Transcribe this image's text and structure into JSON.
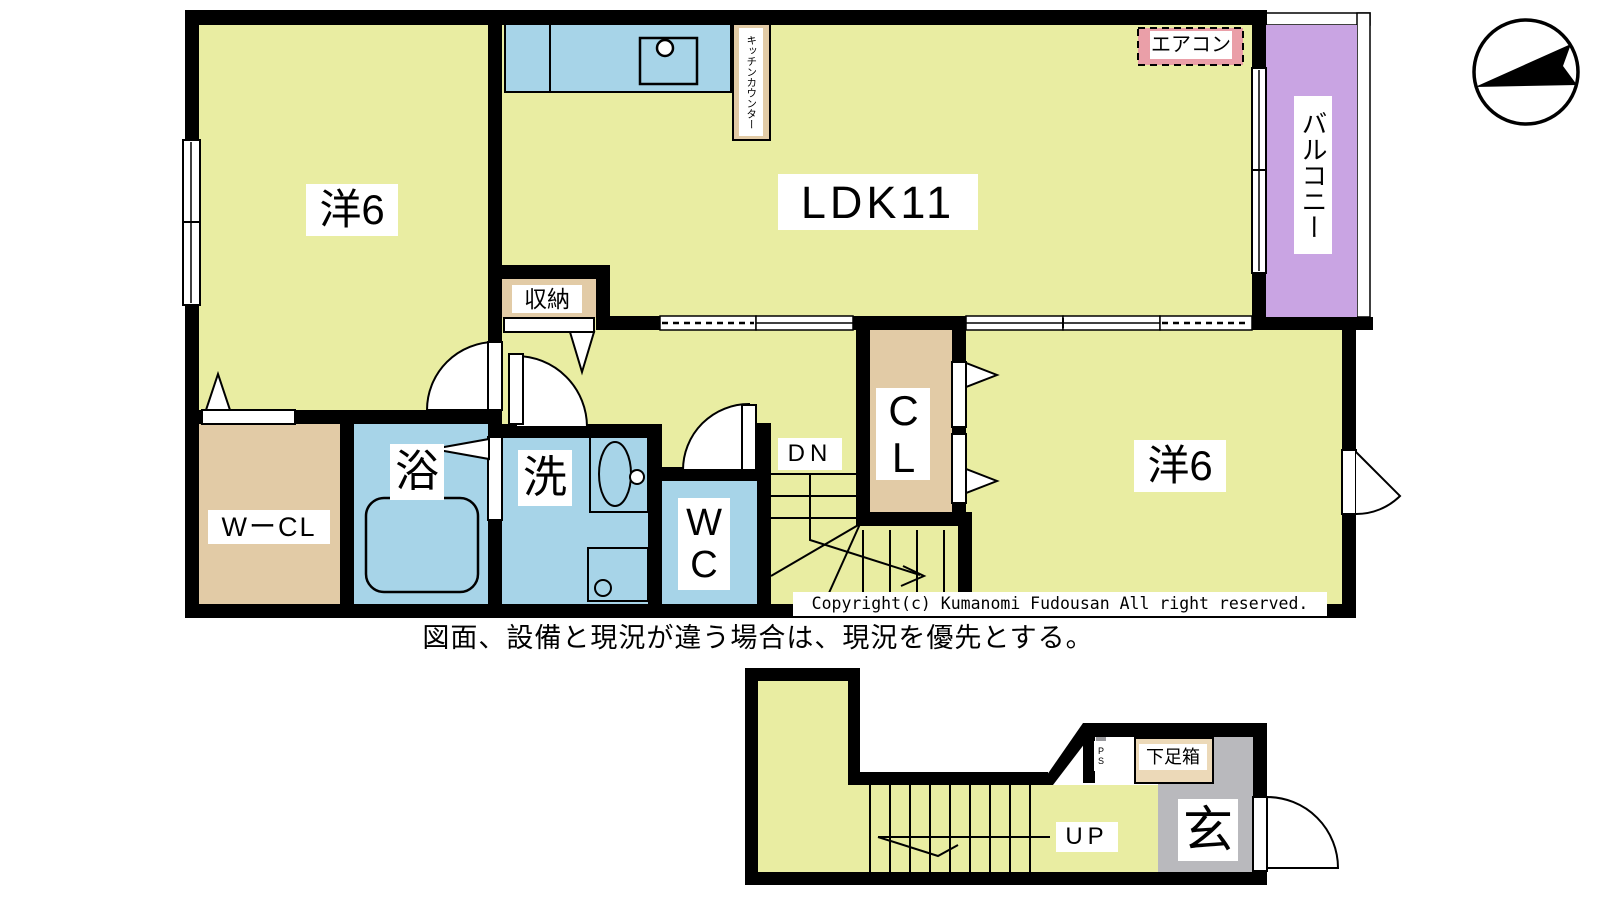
{
  "colors": {
    "floor_yellow": "#e9eda2",
    "water_blue": "#a7d4e8",
    "closet_tan": "#e2cba6",
    "shoebox_tan": "#ecd9b8",
    "balcony_purple": "#c9a4e3",
    "aircon_pink": "#ea9fa8",
    "entry_gray": "#b9b9bd",
    "ps_gray": "#9a9a9e",
    "wall_black": "#000000"
  },
  "floor2": {
    "rooms": {
      "western_left": "洋6",
      "ldk": "LDK11",
      "western_right": "洋6",
      "storage": "収納",
      "bath": "浴",
      "wash": "洗",
      "wc": "WC",
      "closet": "CL",
      "walkin_closet": "WーCL",
      "balcony": "バルコニー",
      "kitchen_counter": "キッチンカウンター",
      "aircon": "エアコン",
      "stairs_down": "DN"
    }
  },
  "floor1": {
    "rooms": {
      "entrance": "玄",
      "shoe_box": "下足箱",
      "pipe_shaft": "PS",
      "stairs_up": "UP"
    }
  },
  "notes": {
    "copyright": "Copyright(c) Kumanomi Fudousan All right reserved.",
    "disclaimer": "図面、設備と現況が違う場合は、現況を優先とする。"
  },
  "compass": {
    "icon": "north-arrow"
  }
}
